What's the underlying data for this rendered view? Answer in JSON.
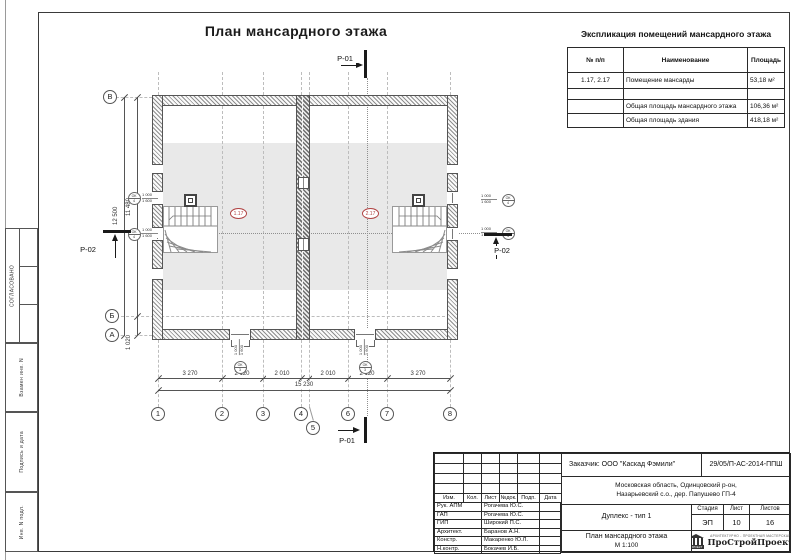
{
  "sheet": {
    "title": "План мансардного этажа"
  },
  "side_strip": {
    "approved": "СОГЛАСОВАНО",
    "replace_inv": "Взамен инв. N",
    "sign_date": "Подпись и дата",
    "inv_num": "Инв. N подл."
  },
  "room_table": {
    "title": "Экспликация помещений мансардного этажа",
    "headers": [
      "№ п/п",
      "Наименование",
      "Площадь"
    ],
    "rows": [
      {
        "num": "1.17, 2.17",
        "name": "Помещение мансарды",
        "area": "53,18 м²"
      },
      {
        "num": "",
        "name": "",
        "area": ""
      },
      {
        "num": "",
        "name": "Общая площадь мансардного этажа",
        "area": "106,36 м²"
      },
      {
        "num": "",
        "name": "Общая площадь здания",
        "area": "418,18 м²"
      }
    ]
  },
  "plan": {
    "axes_bottom": [
      "1",
      "2",
      "3",
      "4",
      "5",
      "6",
      "7",
      "8"
    ],
    "axes_left": [
      "В",
      "Б",
      "А"
    ],
    "dims_bottom": [
      "3 270",
      "2 120",
      "2 010",
      "2 010",
      "2 120",
      "3 270"
    ],
    "dim_total": "15 230",
    "dim_height_full": "12 500",
    "dim_height_upper": "11 480",
    "dim_height_lower": "1 020",
    "section_p01": "Р-01",
    "section_p02": "Р-02",
    "room_tag_left": "1.17",
    "room_tag_right": "2.17",
    "window_tag_side": "ОК-4",
    "window_tag_bottom": "ОК-3",
    "window_width": "1 000",
    "window_height": "1 600"
  },
  "title_block": {
    "client": "Заказчик:  ООО \"Каскад Фэмили\"",
    "code": "29/05/П-АС-2014-ППШ",
    "address_line1": "Московская область, Одинцовский р-он,",
    "address_line2": "Назарьевский с.о.,  дер. Папушево ГП-4",
    "object_name": "Дуплекс -  тип 1",
    "drawing_name": "План мансардного этажа",
    "scale": "М 1:100",
    "stage_label": "Стадия",
    "stage": "ЭП",
    "sheet_label": "Лист",
    "sheet_num": "10",
    "sheets_label": "Листов",
    "sheets_total": "16",
    "rev_headers": [
      "Изм.",
      "Кол.",
      "Лист",
      "№док.",
      "Подп.",
      "Дата"
    ],
    "people": [
      {
        "role": "Рук. АПМ",
        "name": "Рогачева Ю.С."
      },
      {
        "role": "ГАП",
        "name": "Рогачева Ю.С."
      },
      {
        "role": "ГИП",
        "name": "Широкий П.С."
      },
      {
        "role": "Архитект.",
        "name": "Баранов А.Н."
      },
      {
        "role": "Констр.",
        "name": "Макаренко Ю.Л."
      },
      {
        "role": "Н.контр.",
        "name": "Бокачев И.Б."
      }
    ],
    "logo": {
      "name": "ПроСтройПроект",
      "tagline": "АРХИТЕКТУРНО - ПРОЕКТНАЯ МАСТЕРСКАЯ",
      "icon_text": "ПРОЕКТ"
    }
  }
}
